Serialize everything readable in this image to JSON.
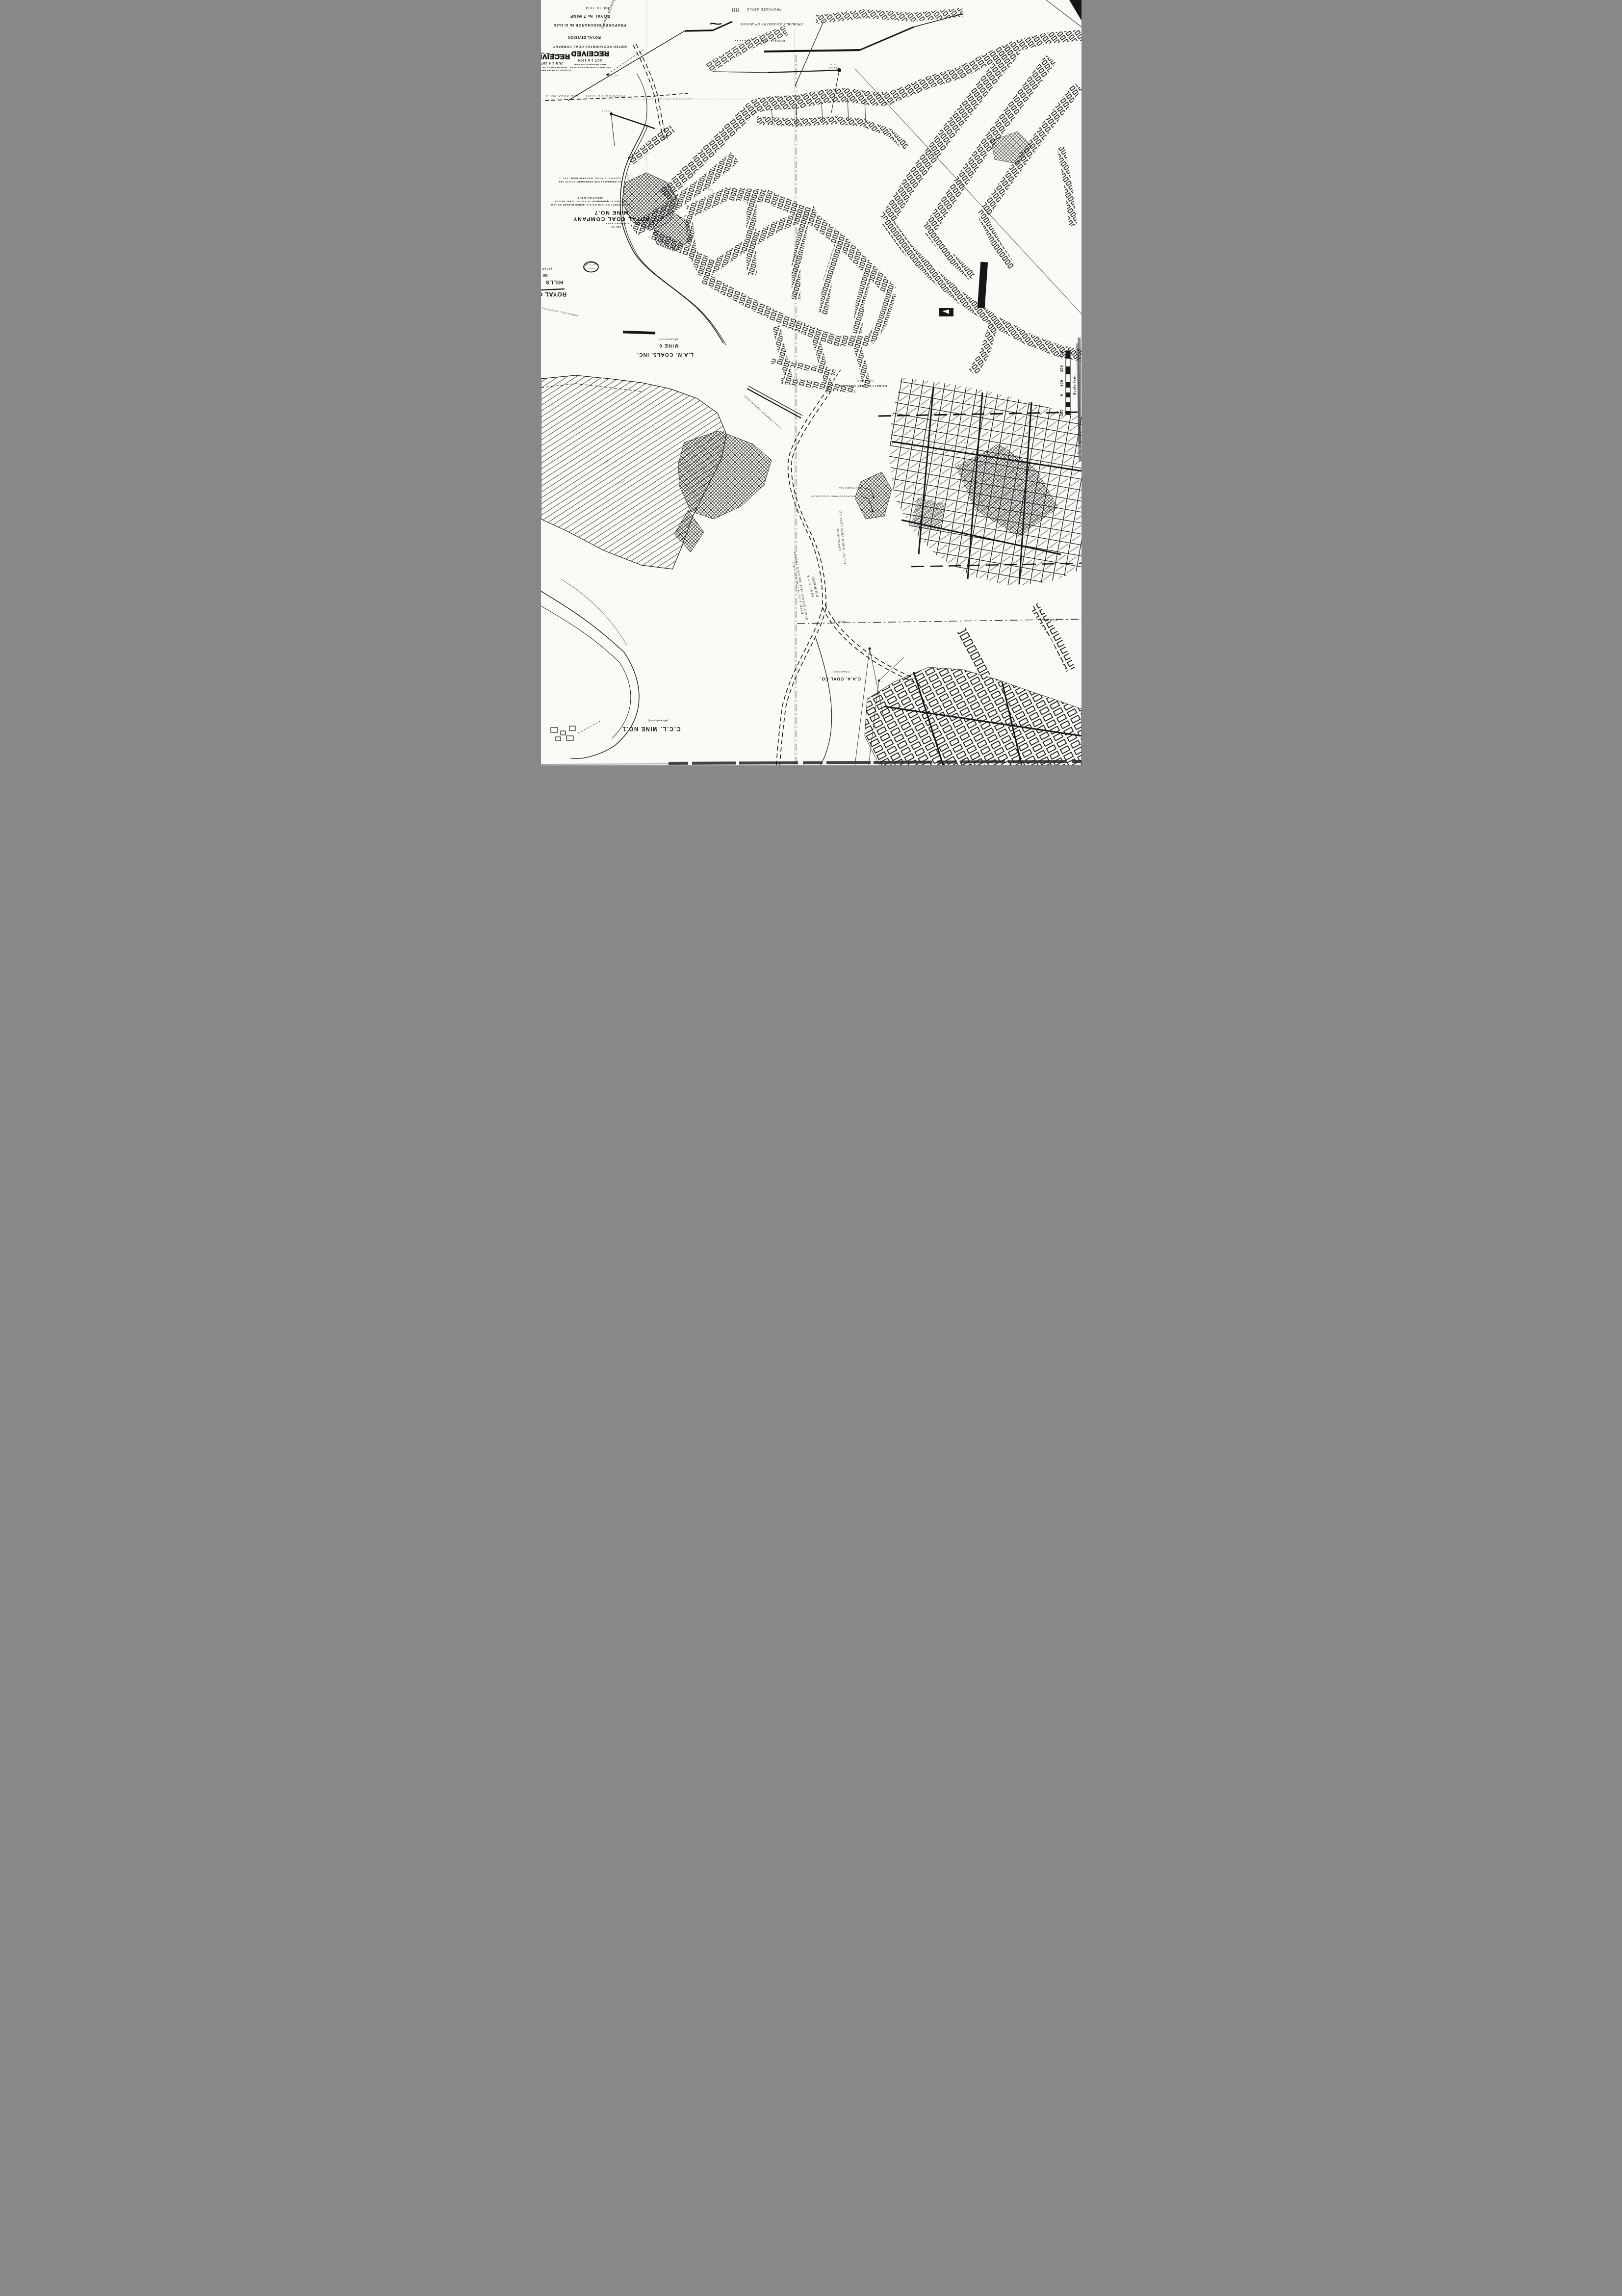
{
  "page": {
    "paper_color": "#fbfaf6",
    "ink_color": "#161616",
    "kind": "scanned abandoned coal mine workings map"
  },
  "title_block": {
    "date": "JUNE 10, 1974",
    "mine": "ROYAL № 7 MINE",
    "discharge": "PROPOSED DISCHARGE № D-1126",
    "division": "ROYAL DIVISION",
    "company": "UNITED POCAHONTAS COAL COMPANY",
    "handwritten_county": "Raleigh County"
  },
  "stamps": {
    "oct": {
      "received": "RECEIVED",
      "date": "OCT 1 6 1974",
      "line1": "DIVISION OF WATER RESOURCES",
      "line2": "MINE DRAINAGE SECTION"
    },
    "jun": {
      "received": "RECEIVED",
      "date": "JUN 1 8 1974",
      "line1": "DIVISION OF WATER RESOURCES",
      "line2": "MINE DRAINAGE SECTION"
    }
  },
  "legend": {
    "proposed_seals": "PROPOSED SEALS",
    "probable_boundary": "PROBABLE BOUNDARY OF MINING",
    "private_road": "PRIVATE ROAD"
  },
  "notes": {
    "coords1": "CO-ORDINATES FOR PERMANENT POINTS ARE",
    "coords2": "LOCATED IN ROYAL TRAVERSE BOOK, VOL. 7",
    "elev1": "ELEVATION 1801.6",
    "elev2": "LOCATED AT QUINNIMONT IN A 60 FT. STEEL BRIDGE.",
    "elev3": "ELEVATIONS TIED INTO U.S.G.S. BENCH MARKER NO.1200",
    "bonded1": "5 BONDED AREA",
    "bonded2": "192 AC."
  },
  "mines": {
    "royal": {
      "line1": "ROYAL COAL COMPANY",
      "line2": "MINE NO.7"
    },
    "lam": {
      "line1": "L.A.M. COALS, INC.",
      "line2": "MINE 6",
      "line3": "(Abandoned)"
    },
    "lilly": {
      "line1": "Former  I.C. LILLY COAL CO.",
      "line2": "(Abandoned)"
    },
    "caa": {
      "line1": "C.A.A. COAL CO.",
      "line2": "(Abandoned)"
    },
    "ccl": {
      "line1": "C.C.L. MINE NO.1",
      "line2": "(Abandoned)"
    },
    "birch": "12,750'  BIRCH TREE COAL CO.",
    "birch2": "(ABANDONED) —",
    "tram": "COAL COMPANY (ABANDONED)",
    "edge1": "ROYAL C",
    "edge2": "HILLS",
    "edge3": "MI",
    "edge4": "(ABAN"
  },
  "proposed_block": {
    "l1": "PROPOSED",
    "l2": "MINE № 7-A",
    "l3": "SHADY SPRING DIST.  RALEIGH COUNTY",
    "l4": "DATE: 4-30-74    SCALE 1\" = 400'",
    "fan": "PROPOSED FAN",
    "pump": "PROPOSED PUMP DISCHARGE"
  },
  "boundary_labels": {
    "fee_area": "FEE AREA NO. 1",
    "pocahontas": "POCAHONTAS  COAL",
    "western": "WESTERN  POCAHONTAS",
    "lerse": "LERSE",
    "n18000": "N 18,000"
  },
  "annotations": {
    "pond1": "(water supply)",
    "pond2": "POND",
    "power": "POWER POLL STRUCTURE",
    "not_signed": "not signed",
    "cor54": "COR 54",
    "oak": "OAK 5.5",
    "cor57": "COR 57",
    "p55a": "5.5",
    "p55b": "5.5"
  },
  "elevations": {
    "e1": "1991.0",
    "e2": "2296.2",
    "e3": "2342.6",
    "e4": "2351.4",
    "e5": "2750.0",
    "e6": "2296.5",
    "seam": "SEAM"
  },
  "scale_bar": {
    "caption": "Scale  feet",
    "t100b": "100",
    "t0": "0",
    "t100": "100",
    "t200": "200",
    "t300": "300"
  }
}
